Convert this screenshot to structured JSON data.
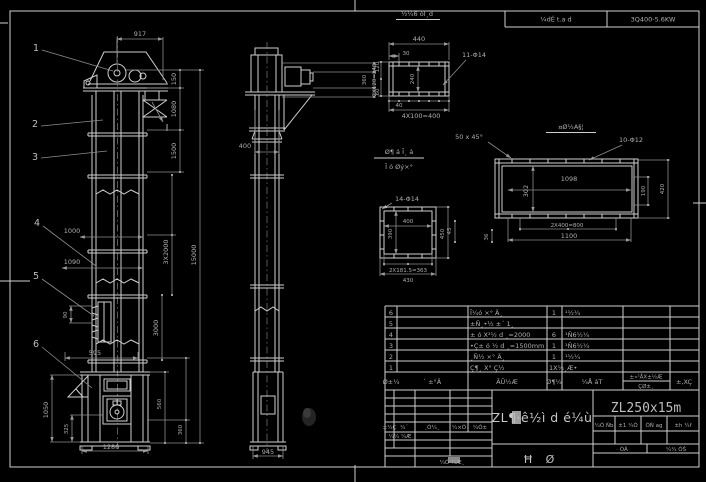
{
  "sheet": {
    "bg": "#000000",
    "line_color": "#cfcfcf",
    "dim_color": "#8d8d8d"
  },
  "top_header": {
    "left_cell": "¼dÊ t.a d",
    "right_cell": "3Q400-5.6KW"
  },
  "front_view": {
    "balloons": [
      "1",
      "2",
      "3",
      "4",
      "5",
      "6"
    ],
    "section_mark": "I",
    "dims": {
      "w917": "917",
      "h150": "150",
      "h1080": "1080",
      "h1500": "1500",
      "h15000": "15000",
      "c3x2000": "3X2000",
      "c3000": "3000",
      "w1000": "1000",
      "w1090": "1090",
      "p90": "90",
      "w595": "595",
      "h1050": "1050",
      "h325": "325",
      "w1286": "1286",
      "h560": "560",
      "h360": "360"
    }
  },
  "side_view": {
    "dims": {
      "d400": "400",
      "d945": "945",
      "d360": "360",
      "d120": "120",
      "d60": "60"
    }
  },
  "detail_channel": {
    "title": "½¼6 óĪ¸d",
    "dims": {
      "w440": "440",
      "o30": "30",
      "holes": "11-Φ14",
      "left": "2X120=240",
      "mid": "240",
      "o40": "40",
      "bottom": "4X100=400"
    }
  },
  "detail_plate": {
    "title": "¤Ø½A§¦",
    "chamfer": "50 x 45°",
    "holes": "10-Φ12",
    "dims": {
      "w1098": "1098",
      "h302": "302",
      "h190": "190",
      "h420": "420",
      "b800": "2X400=800",
      "b1100": "1100",
      "s36": "36",
      "s45": "45"
    }
  },
  "detail_flange": {
    "holes": "14-Φ14",
    "dims": {
      "w400": "400",
      "h390": "390",
      "h450": "450",
      "b363": "2X181.5=363",
      "b430": "430"
    }
  },
  "inlet_note": {
    "line1": "Ø¶ á Ī¸ á",
    "line2": "Ī ó Øý×°"
  },
  "parts_table": {
    "headers": {
      "no": "Ø±¼",
      "name": "´ ±°Ä",
      "desc": "ÃÛ½Æ",
      "qty": "Ø¶¼",
      "material": "¼Å áT",
      "weight_top": "±«²ÅX±½Æ",
      "weight_bottom": "ÇØ±¸",
      "note": "±,XÇ"
    },
    "rows": [
      {
        "no": "6",
        "desc": "Ī¼ó ×° Ä¸",
        "qty": "1",
        "material": "¹½¼"
      },
      {
        "no": "5",
        "desc": "±Ñ¸•½ ±´ 1¸",
        "qty": "",
        "material": ""
      },
      {
        "no": "4",
        "desc": "± ó X²½ d ¸=2000",
        "qty": "6",
        "material": "¹Ñ6½¼"
      },
      {
        "no": "3",
        "desc": "•Ç± ó ½ d ¸=1500mm",
        "qty": "1",
        "material": "¹Ñ6½¼"
      },
      {
        "no": "2",
        "desc": "¸Ñ½ ×° Ä¸",
        "qty": "1",
        "material": "¹½¼"
      },
      {
        "no": "1",
        "desc": "Ç¶¸ X° Ç½",
        "qty": "1X¼¸Æ•",
        "material": ""
      }
    ]
  },
  "title_block": {
    "model": "ZL250x15m",
    "drawing_title": "ZL¶·ê½ì d é¼ù",
    "stamp_left": "Ħ",
    "stamp_right": "Ø",
    "revision": {
      "h1": "±¼Ç",
      "h2": "¼´",
      "h3": "¸Ò¼¸",
      "h4": "¼×Ó",
      "h5": "¼Ó±",
      "row1": "¼¼ ¼Æ",
      "row2": "¼Ó ¼Æ¸"
    },
    "info": {
      "c1": "¼Ó Ñb",
      "c2": "±1 ¼Ò",
      "c3": "ÓÑ ag",
      "c4": "±h ¼f",
      "s1": "· ÓÁ",
      "s2": "¼¼ ÓŠ"
    }
  }
}
